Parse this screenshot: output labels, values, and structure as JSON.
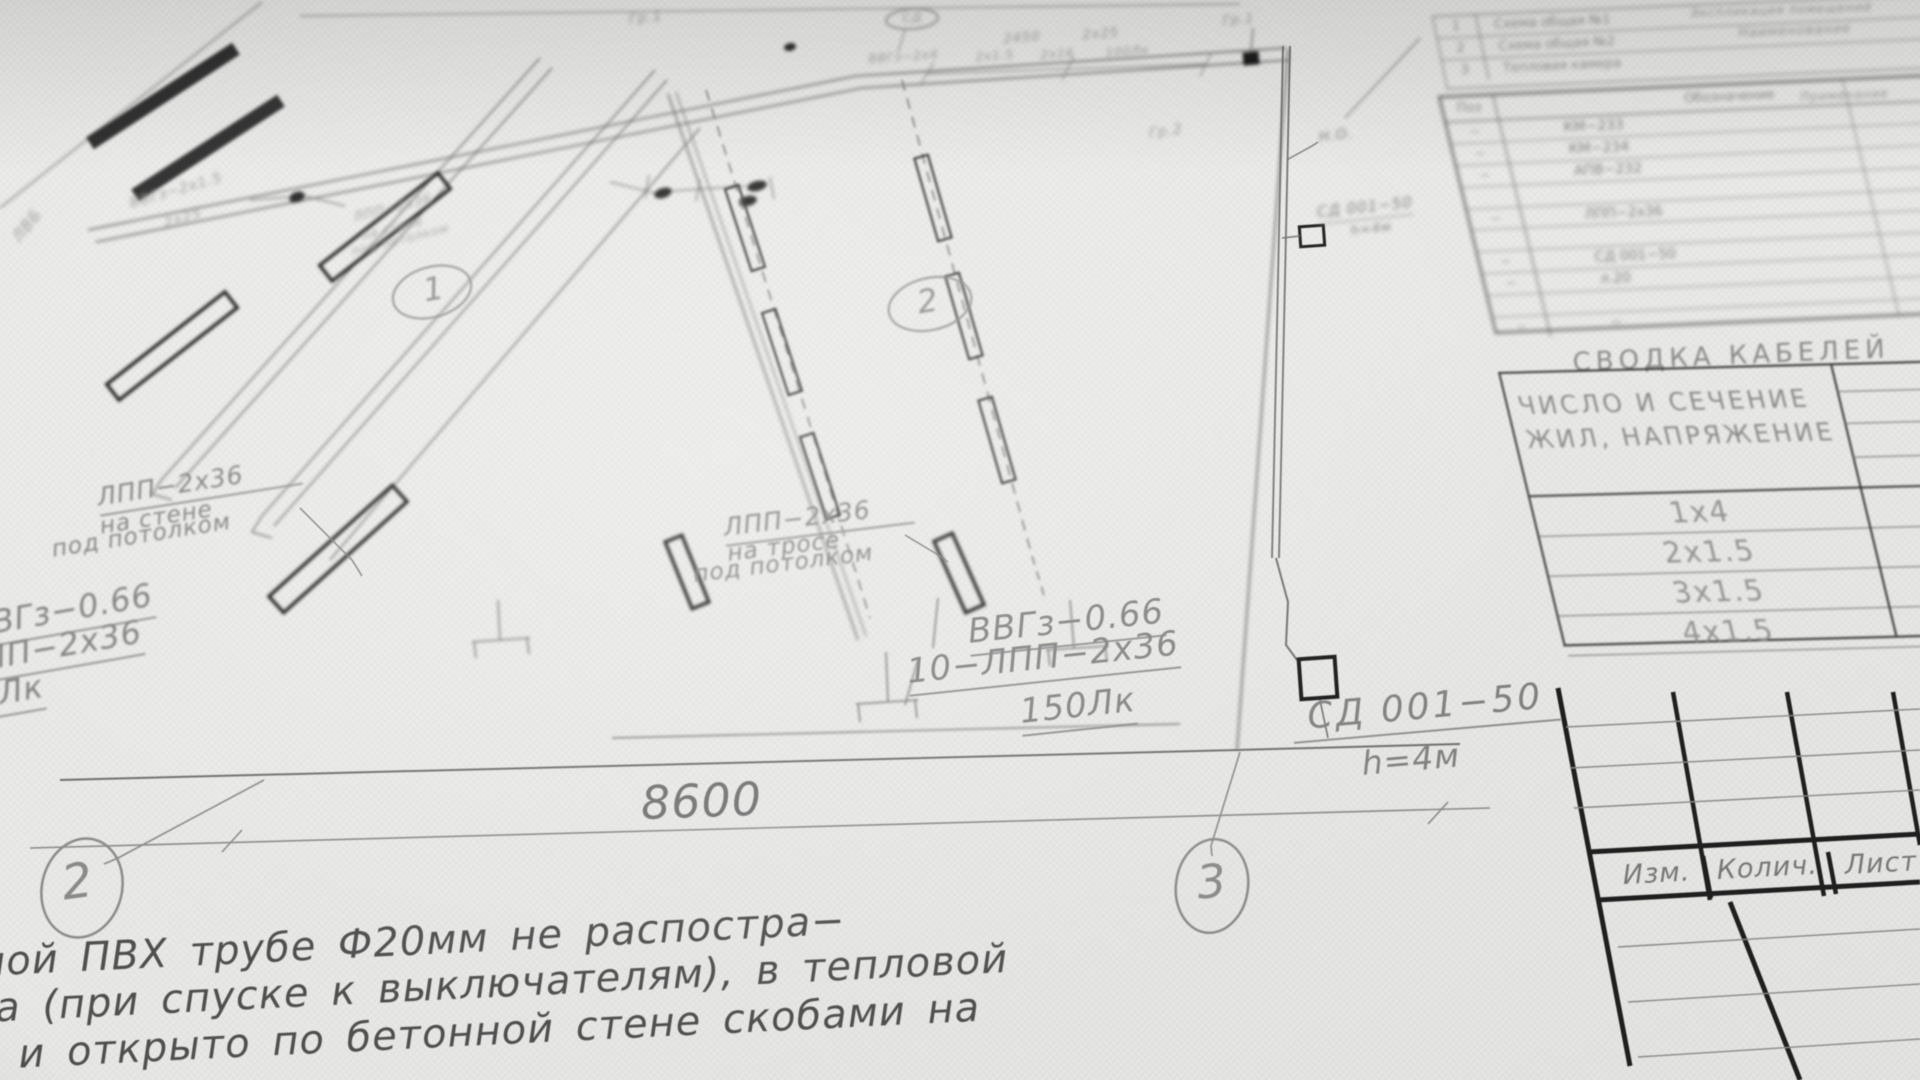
{
  "plan": {
    "dimension_main": "8600",
    "dimension_top_a": "2450",
    "dimension_top_b": "2х25",
    "axis_bubbles": {
      "left": "2",
      "right": "3"
    },
    "room_numbers": {
      "room1": "1",
      "room2": "2"
    },
    "labels": {
      "wall_mount": {
        "l1": "ЛПП−2х36",
        "l2": "на стене",
        "l3": "под потолком"
      },
      "cable_mount": {
        "l1": "ЛПП−2х36",
        "l2": "на тросе",
        "l3": "под потолком"
      },
      "edge_cut": {
        "cable": "ВВГз−0.66",
        "lamp": "ЛПП−2х36",
        "lux": "150Лк"
      },
      "group_right": {
        "cable": "ВВГз−0.66",
        "circuit": "10−ЛПП−2х36",
        "lux": "150Лк"
      },
      "switch_main": {
        "name": "СД 001−50",
        "height": "h=4м"
      },
      "switch_top": {
        "name": "СД 001−50",
        "height": "h=4м"
      },
      "normally_open": "Н.О.",
      "tiny": {
        "t1": "ВВГз−2х1.5",
        "t2": "2х25",
        "t3": "ЛПП−2х36",
        "t4": "на стене",
        "t5": "под потолком",
        "t6": "Гр.1",
        "t7": "СД",
        "t8": "ВВГз−2х4",
        "t9": "2х1.5",
        "t10": "2х16",
        "t11": "100Лк",
        "t12": "Гр.2",
        "t13": "Гр.1",
        "t14": "ЛВБ"
      }
    },
    "note_lines": {
      "l1": "ной ПВХ трубе Ф20мм не распостра−",
      "l2": "ола (при спуске к выключателям), в тепловой",
      "l3": "е и открыто по бетонной стене скобами на"
    }
  },
  "tables": {
    "rooms": {
      "title": "Экспликация помещений",
      "name_header": "Наименование",
      "rows": [
        {
          "num": "1",
          "name": "Схема общая №1"
        },
        {
          "num": "2",
          "name": "Схема общая №2"
        },
        {
          "num": "3",
          "name": "Тепловая камера"
        }
      ]
    },
    "equipment": {
      "pos_header": "Поз",
      "designation_header": "Обозначение",
      "note_header": "Примечание",
      "rows": [
        {
          "pos": "−",
          "name": "КМ−233"
        },
        {
          "pos": "−",
          "name": "КМ−234"
        },
        {
          "pos": "−",
          "name": "АПВ−232"
        },
        {
          "pos": "",
          "name": ""
        },
        {
          "pos": "−",
          "name": "ЛПП−2х36"
        },
        {
          "pos": "",
          "name": ""
        },
        {
          "pos": "−",
          "name": "СД 001−50"
        },
        {
          "pos": "−",
          "name": "л.20"
        },
        {
          "pos": "",
          "name": ""
        },
        {
          "pos": "−",
          "name": "−"
        }
      ]
    },
    "cables": {
      "title": "СВОДКА КАБЕЛЕЙ",
      "header_l1": "ЧИСЛО И СЕЧЕНИЕ",
      "header_l2": "ЖИЛ, НАПРЯЖЕНИЕ",
      "rows": [
        "1х4",
        "2х1.5",
        "3х1.5",
        "4х1.5"
      ]
    },
    "title_block": {
      "c1": "Изм.",
      "c2": "Колич.",
      "c3": "Лист"
    }
  },
  "colors": {
    "paper": "#e9e9e7",
    "ink_bold": "#1c1c1c",
    "ink_thin": "#777777",
    "text_gray": "#7f7f7f"
  }
}
